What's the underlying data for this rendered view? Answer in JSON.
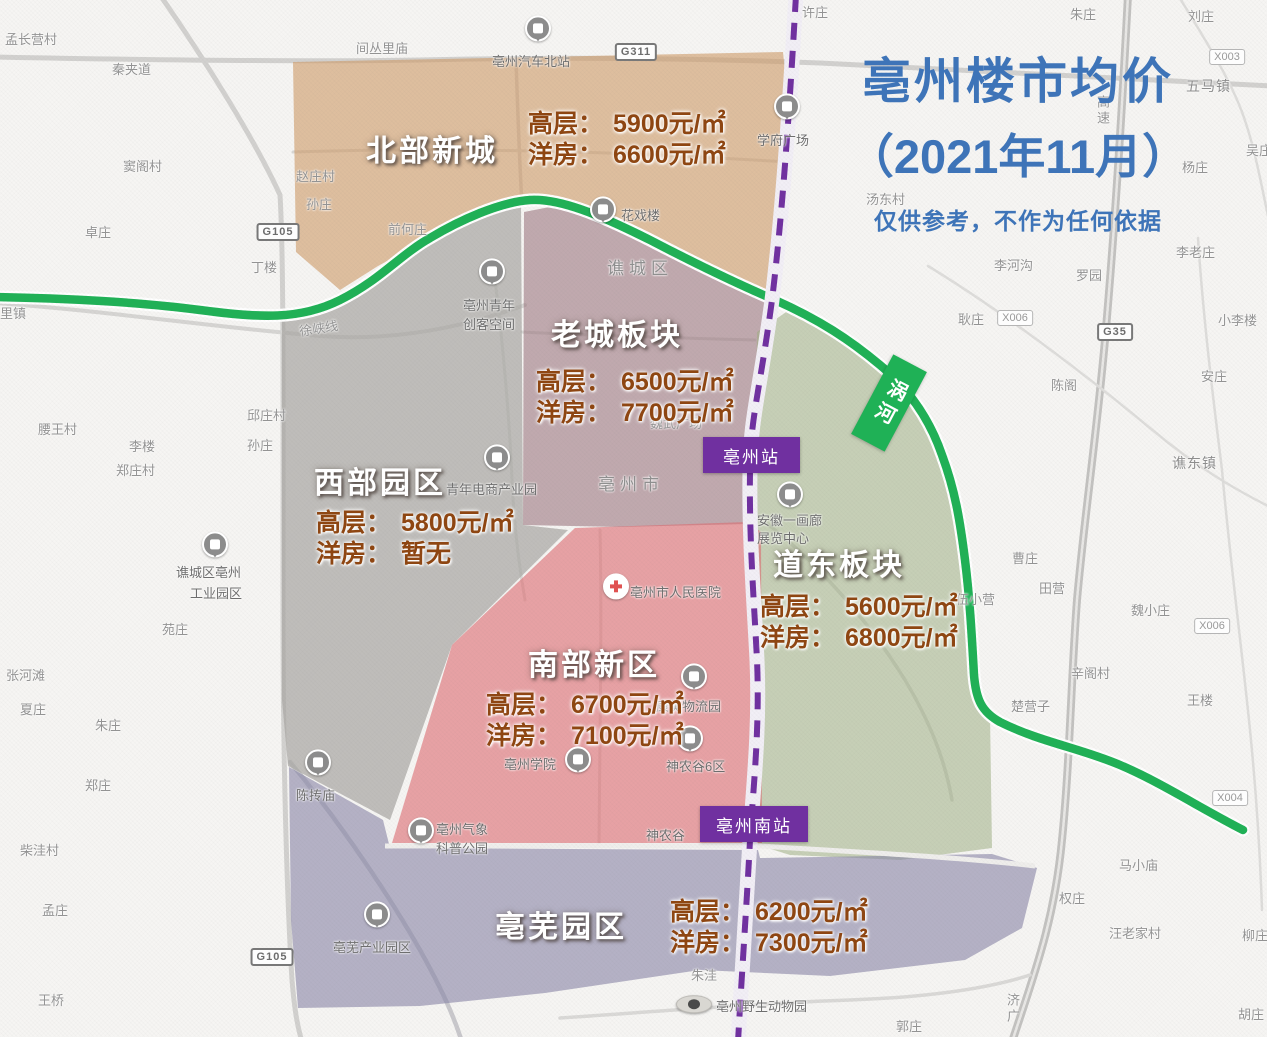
{
  "title": {
    "line1": "亳州楼市均价",
    "line2": "（2021年11月）",
    "disclaimer": "仅供参考，不作为任何依据",
    "color": "#3E74B8"
  },
  "districts": [
    {
      "id": "north",
      "name": "北部新城",
      "hl_label": "高层：",
      "hl_value": "5900元/㎡",
      "yf_label": "洋房：",
      "yf_value": "6600元/㎡",
      "color": "#CE9A66",
      "opacity": 0.6
    },
    {
      "id": "oldtown",
      "name": "老城板块",
      "hl_label": "高层：",
      "hl_value": "6500元/㎡",
      "yf_label": "洋房：",
      "yf_value": "7700元/㎡",
      "color": "#9E7B82",
      "opacity": 0.62
    },
    {
      "id": "west",
      "name": "西部园区",
      "hl_label": "高层：",
      "hl_value": "5800元/㎡",
      "yf_label": "洋房：",
      "yf_value": "暂无",
      "color": "#A9A7A4",
      "opacity": 0.72
    },
    {
      "id": "daodong",
      "name": "道东板块",
      "hl_label": "高层：",
      "hl_value": "5600元/㎡",
      "yf_label": "洋房：",
      "yf_value": "6800元/㎡",
      "color": "#9FAE83",
      "opacity": 0.55
    },
    {
      "id": "south",
      "name": "南部新区",
      "hl_label": "高层：",
      "hl_value": "6700元/㎡",
      "yf_label": "洋房：",
      "yf_value": "7100元/㎡",
      "color": "#DD6E72",
      "opacity": 0.62
    },
    {
      "id": "bowu",
      "name": "亳芜园区",
      "hl_label": "高层：",
      "hl_value": "6200元/㎡",
      "yf_label": "洋房：",
      "yf_value": "7300元/㎡",
      "color": "#8A87A8",
      "opacity": 0.62
    }
  ],
  "price_color": "#8E4612",
  "stations": [
    {
      "name": "亳州站"
    },
    {
      "name": "亳州南站"
    }
  ],
  "station_color": "#7030A0",
  "rail_color": "#7030A0",
  "river": {
    "label": "涡河",
    "color": "#1FB156"
  },
  "map_labels": [
    {
      "t": "孟长营村",
      "x": 5,
      "y": 29
    },
    {
      "t": "秦夹道",
      "x": 112,
      "y": 59
    },
    {
      "t": "窦阁村",
      "x": 123,
      "y": 156
    },
    {
      "t": "卓庄",
      "x": 85,
      "y": 222
    },
    {
      "t": "里镇",
      "x": 0,
      "y": 303
    },
    {
      "t": "许庄",
      "x": 802,
      "y": 2
    },
    {
      "t": "朱庄",
      "x": 1070,
      "y": 4
    },
    {
      "t": "刘庄",
      "x": 1188,
      "y": 6
    },
    {
      "t": "五马镇",
      "x": 1186,
      "y": 76,
      "c": "md"
    },
    {
      "t": "吴庄",
      "x": 1246,
      "y": 140
    },
    {
      "t": "杨庄",
      "x": 1182,
      "y": 157
    },
    {
      "t": "汤东村",
      "x": 866,
      "y": 189
    },
    {
      "t": "李老庄",
      "x": 1176,
      "y": 242
    },
    {
      "t": "李河沟",
      "x": 994,
      "y": 255
    },
    {
      "t": "罗园",
      "x": 1076,
      "y": 265
    },
    {
      "t": "小李楼",
      "x": 1218,
      "y": 310
    },
    {
      "t": "耿庄",
      "x": 958,
      "y": 309
    },
    {
      "t": "陈阁",
      "x": 1051,
      "y": 375
    },
    {
      "t": "安庄",
      "x": 1201,
      "y": 366
    },
    {
      "t": "谯东镇",
      "x": 1172,
      "y": 453,
      "c": "md"
    },
    {
      "t": "间丛里庙",
      "x": 356,
      "y": 38
    },
    {
      "t": "亳州汽车北站",
      "x": 492,
      "y": 51,
      "c": "dk"
    },
    {
      "t": "赵庄村",
      "x": 296,
      "y": 166
    },
    {
      "t": "孙庄",
      "x": 306,
      "y": 194
    },
    {
      "t": "前何庄",
      "x": 388,
      "y": 219
    },
    {
      "t": "丁楼",
      "x": 251,
      "y": 257
    },
    {
      "t": "花戏楼",
      "x": 621,
      "y": 205,
      "c": "dk"
    },
    {
      "t": "谯城区",
      "x": 607,
      "y": 254,
      "c": "big"
    },
    {
      "t": "徐峡线",
      "x": 299,
      "y": 318,
      "r": -9
    },
    {
      "t": "亳州青年",
      "x": 463,
      "y": 295,
      "c": "dk"
    },
    {
      "t": "创客空间",
      "x": 463,
      "y": 314,
      "c": "dk"
    },
    {
      "t": "学府广场",
      "x": 757,
      "y": 130,
      "c": "dk"
    },
    {
      "t": "邱庄村",
      "x": 247,
      "y": 405
    },
    {
      "t": "孙庄",
      "x": 247,
      "y": 435
    },
    {
      "t": "腰王村",
      "x": 38,
      "y": 419
    },
    {
      "t": "李楼",
      "x": 129,
      "y": 436
    },
    {
      "t": "郑庄村",
      "x": 116,
      "y": 460
    },
    {
      "t": "魏武广场",
      "x": 650,
      "y": 413
    },
    {
      "t": "亳州市",
      "x": 598,
      "y": 470,
      "c": "big"
    },
    {
      "t": "青年电商产业园",
      "x": 446,
      "y": 479,
      "c": "dk"
    },
    {
      "t": "安徽一画廊",
      "x": 757,
      "y": 510,
      "c": "dk"
    },
    {
      "t": "展览中心",
      "x": 757,
      "y": 528,
      "c": "dk"
    },
    {
      "t": "谯城区亳州",
      "x": 176,
      "y": 562,
      "c": "dk"
    },
    {
      "t": "工业园区",
      "x": 190,
      "y": 583,
      "c": "dk"
    },
    {
      "t": "苑庄",
      "x": 162,
      "y": 619
    },
    {
      "t": "张河滩",
      "x": 6,
      "y": 665
    },
    {
      "t": "夏庄",
      "x": 20,
      "y": 699
    },
    {
      "t": "朱庄",
      "x": 95,
      "y": 715
    },
    {
      "t": "郑庄",
      "x": 85,
      "y": 775
    },
    {
      "t": "曹庄",
      "x": 1012,
      "y": 548
    },
    {
      "t": "田营",
      "x": 1039,
      "y": 578
    },
    {
      "t": "伍小营",
      "x": 956,
      "y": 589
    },
    {
      "t": "魏小庄",
      "x": 1131,
      "y": 600
    },
    {
      "t": "辛阁村",
      "x": 1071,
      "y": 663
    },
    {
      "t": "王楼",
      "x": 1187,
      "y": 690
    },
    {
      "t": "楚营子",
      "x": 1011,
      "y": 696
    },
    {
      "t": "亳州市人民医院",
      "x": 630,
      "y": 582,
      "c": "dk"
    },
    {
      "t": "康美物流园",
      "x": 656,
      "y": 696,
      "c": "dk"
    },
    {
      "t": "神农谷6区",
      "x": 666,
      "y": 756,
      "c": "dk"
    },
    {
      "t": "亳州学院",
      "x": 504,
      "y": 754,
      "c": "dk"
    },
    {
      "t": "神农谷",
      "x": 646,
      "y": 825,
      "c": "dk"
    },
    {
      "t": "陈抟庙",
      "x": 296,
      "y": 785,
      "c": "dk"
    },
    {
      "t": "柴洼村",
      "x": 20,
      "y": 840
    },
    {
      "t": "孟庄",
      "x": 42,
      "y": 900
    },
    {
      "t": "王桥",
      "x": 38,
      "y": 990
    },
    {
      "t": "亳州气象",
      "x": 436,
      "y": 819,
      "c": "dk"
    },
    {
      "t": "科普公园",
      "x": 436,
      "y": 838,
      "c": "dk"
    },
    {
      "t": "亳芜产业园区",
      "x": 333,
      "y": 937,
      "c": "dk"
    },
    {
      "t": "马小庙",
      "x": 1119,
      "y": 855
    },
    {
      "t": "权庄",
      "x": 1059,
      "y": 888
    },
    {
      "t": "汪老家村",
      "x": 1109,
      "y": 923
    },
    {
      "t": "柳庄",
      "x": 1242,
      "y": 925
    },
    {
      "t": "朱洼",
      "x": 691,
      "y": 965
    },
    {
      "t": "亳州野生动物园",
      "x": 716,
      "y": 996,
      "c": "dk"
    },
    {
      "t": "郭庄",
      "x": 896,
      "y": 1016
    },
    {
      "t": "胡庄",
      "x": 1238,
      "y": 1004
    },
    {
      "t": "高速",
      "x": 1093,
      "y": 95,
      "v": 1
    },
    {
      "t": "济广",
      "x": 1003,
      "y": 993,
      "v": 1
    }
  ],
  "pois": [
    {
      "x": 538,
      "y": 31,
      "t": "building",
      "n": "bus-north-station-icon"
    },
    {
      "x": 603,
      "y": 212,
      "t": "building",
      "n": "huaxilou-icon"
    },
    {
      "x": 492,
      "y": 274,
      "t": "building",
      "n": "maker-space-icon"
    },
    {
      "x": 787,
      "y": 109,
      "t": "building",
      "n": "xuefu-plaza-icon"
    },
    {
      "x": 497,
      "y": 460,
      "t": "building",
      "n": "ecommerce-park-icon"
    },
    {
      "x": 215,
      "y": 547,
      "t": "building",
      "n": "industrial-park-icon"
    },
    {
      "x": 616,
      "y": 589,
      "t": "hospital",
      "n": "peoples-hospital-icon"
    },
    {
      "x": 790,
      "y": 497,
      "t": "building",
      "n": "gallery-center-icon"
    },
    {
      "x": 694,
      "y": 679,
      "t": "building",
      "n": "kangmei-logistics-icon"
    },
    {
      "x": 690,
      "y": 741,
      "t": "building",
      "n": "shennonggu6-icon"
    },
    {
      "x": 578,
      "y": 762,
      "t": "building",
      "n": "bozhou-college-icon"
    },
    {
      "x": 318,
      "y": 765,
      "t": "building",
      "n": "chentuan-temple-icon"
    },
    {
      "x": 421,
      "y": 833,
      "t": "building",
      "n": "weather-park-icon"
    },
    {
      "x": 377,
      "y": 917,
      "t": "building",
      "n": "bowu-industry-park-icon"
    },
    {
      "x": 694,
      "y": 1006,
      "t": "panda",
      "n": "wildlife-park-icon"
    }
  ],
  "road_badges": [
    {
      "t": "G105",
      "x": 278,
      "y": 232,
      "c": "g"
    },
    {
      "t": "G311",
      "x": 636,
      "y": 52,
      "c": "g"
    },
    {
      "t": "X003",
      "x": 1227,
      "y": 57,
      "c": "x"
    },
    {
      "t": "X006",
      "x": 1015,
      "y": 318,
      "c": "x"
    },
    {
      "t": "G35",
      "x": 1115,
      "y": 332,
      "c": "g"
    },
    {
      "t": "X006",
      "x": 1212,
      "y": 626,
      "c": "x"
    },
    {
      "t": "X004",
      "x": 1230,
      "y": 798,
      "c": "x"
    },
    {
      "t": "G105",
      "x": 272,
      "y": 957,
      "c": "g"
    }
  ]
}
